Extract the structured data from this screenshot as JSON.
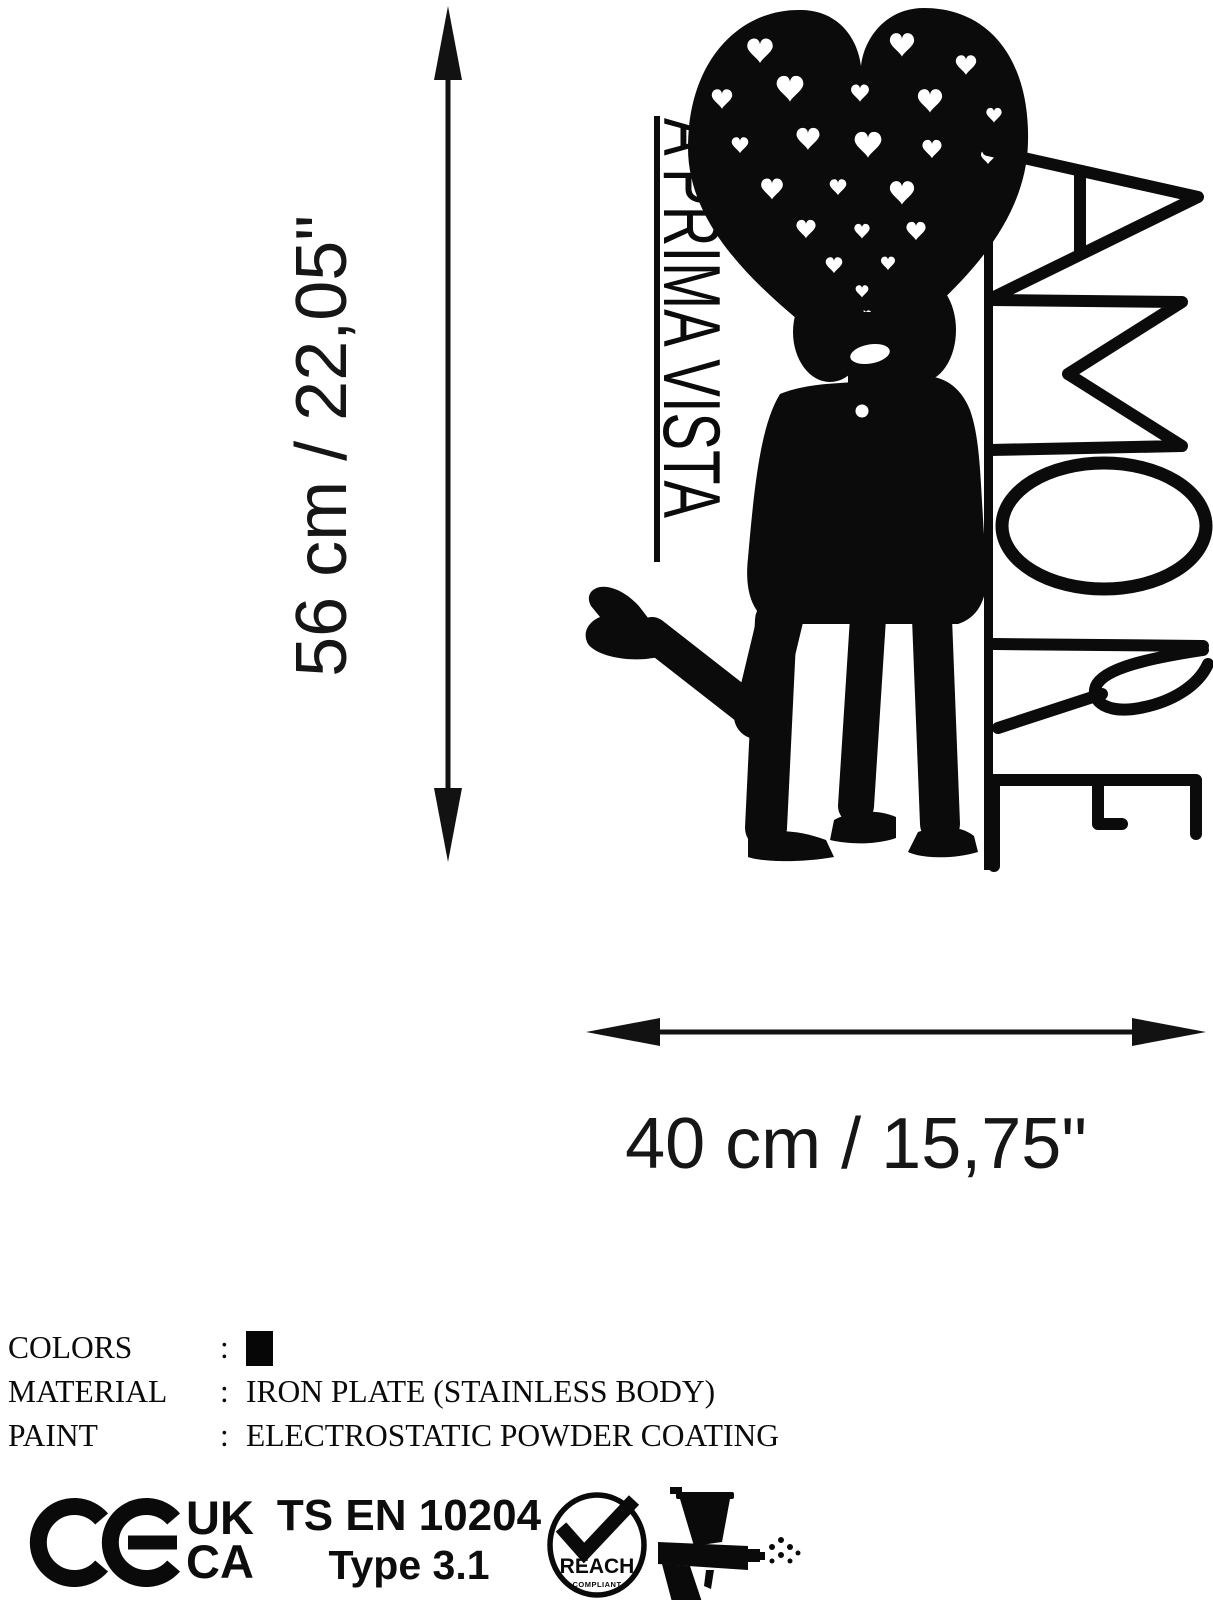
{
  "page": {
    "background": "#ffffff",
    "ink": "#000000"
  },
  "dimensions": {
    "height_label": "56 cm / 22,05\"",
    "width_label": "40 cm / 15,75\""
  },
  "artwork": {
    "left_text": "A PRIMA VISTA",
    "right_text": "AMORE"
  },
  "specs": {
    "rows": [
      {
        "label": "COLORS",
        "separator": ":",
        "value": "",
        "swatch_color": "#000000"
      },
      {
        "label": "MATERIAL",
        "separator": ":",
        "value": "IRON PLATE (STAINLESS BODY)"
      },
      {
        "label": "PAINT",
        "separator": ":",
        "value": "ELECTROSTATIC POWDER COATING"
      }
    ]
  },
  "certifications": {
    "ce_label": "CE",
    "ukca_line1": "UK",
    "ukca_line2": "CA",
    "standard_line1": "TS EN 10204",
    "standard_line2": "Type 3.1",
    "reach_label": "REACH",
    "reach_sublabel": "COMPLIANT"
  }
}
